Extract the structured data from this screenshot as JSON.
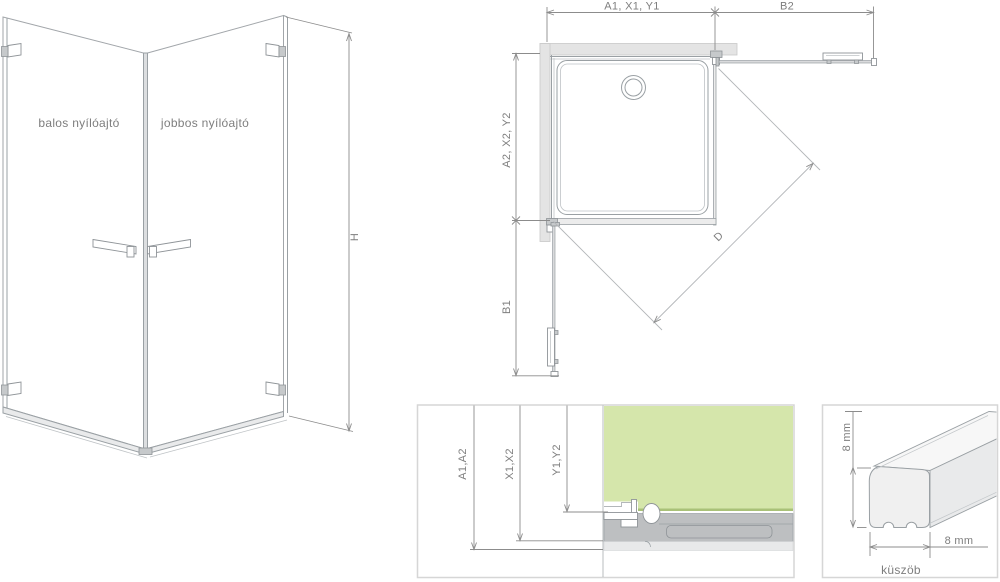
{
  "isometric_view": {
    "left_door_label": "balos nyílóajtó",
    "right_door_label": "jobbos nyílóajtó",
    "height_label": "H"
  },
  "plan_view": {
    "top_width_label": "A1, X1, Y1",
    "door_right_width_label": "B2",
    "side_depth_label": "A2, X2, Y2",
    "door_left_width_label": "B1",
    "diagonal_label": "D"
  },
  "section_detail": {
    "dim_outer_label": "A1,A2",
    "dim_mid_label": "X1,X2",
    "dim_inner_label": "Y1,Y2"
  },
  "threshold_detail": {
    "height_label": "8 mm",
    "width_label": "8 mm",
    "caption": "küszöb"
  },
  "colors": {
    "glass_green": "#d5e6ab",
    "glass_edge_olive": "#a9c178",
    "wall_gray": "#e4e4e4",
    "tray_gray": "#bdbfc1",
    "light_band_gray": "#e8e9ea",
    "line_gray": "#9aa0a4",
    "dimension_gray": "#8c8c8c",
    "label_gray": "#7e7e7e",
    "panel_border": "#d6d6d6"
  }
}
